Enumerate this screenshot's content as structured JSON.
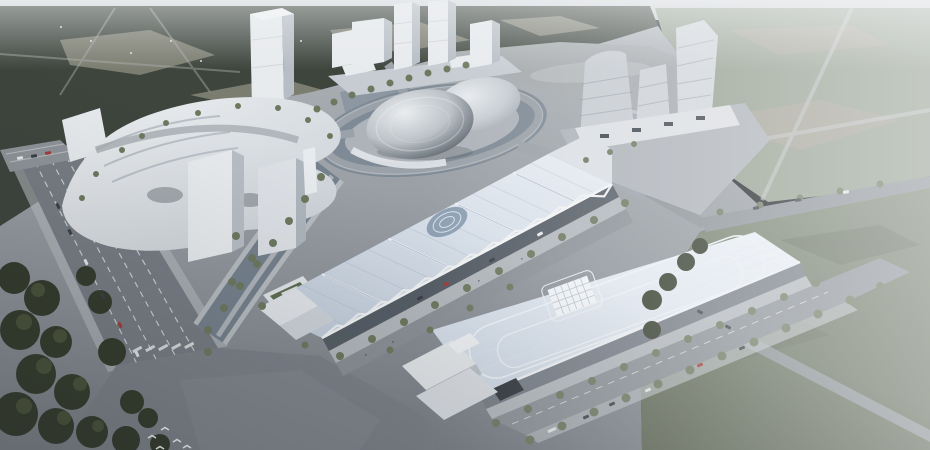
{
  "meta": {
    "type": "architectural-aerial-rendering",
    "description": "Aerial architectural rendering of a cultural and exhibition district: a metallic egg-shaped dome theater inside an elliptical ring road surrounded by water, a white terraced retail podium with slab towers on the left, twin high-rise towers and a lake at top, a cluster of twisted mid-rise towers on the right, two long exhibition halls with pale-blue metal roofs (one with a white zigzag truss facade, one with a central grid skylight), wide tree-lined boulevards with sparse traffic, dense dark forest park to the north-west and hazy sage-green woodland to the east and south-east, small white birds flying over the south-west plaza."
  },
  "colors": {
    "skyTop": "#dadde0",
    "skyBottom": "#c9cdd1",
    "forestDark": "#3d453d",
    "forestClearing": "#7b7d70",
    "forestSage": "#95a090",
    "sageClearing": "#a3a296",
    "forestSE": "#7e8876",
    "forestSEDark": "#59624f",
    "treeDark": "#343b2c",
    "treeCap": "#49523a",
    "treeStreet": "#6d785f",
    "lake": "#a6aaad",
    "waterArm": "#8d97a1",
    "canal": "#75818d",
    "ringWater": "#7e8a95",
    "ringRoad": "#9aa1a8",
    "plaza": "#aeb3b9",
    "ground": "#a9aeb3",
    "groundDark": "#7c8289",
    "roadMain": "#777d84",
    "roadMid": "#8b9197",
    "lane": "#e8eaec",
    "sidewalk": "#b7bcc1",
    "bldgWhite": "#e8ebee",
    "bldgShade": "#b6bdc4",
    "bldgDark": "#8f969e",
    "domeDark": "#474e55",
    "roofSeam": "#9fb0c2",
    "trussWhite": "#eef0f2",
    "trussDark": "#555d66",
    "hallFacade": "#757c85",
    "apron": "#b3b8bd",
    "greenRoof": "#5e6d50",
    "carDark": "#3a4046",
    "carRed": "#a33b36",
    "carWhite": "#e6e8e9",
    "bird": "#f5f6f7"
  },
  "scene": {
    "landmarks": [
      {
        "name": "dome-theater",
        "kind": "egg-shaped metallic dome with secondary shell"
      },
      {
        "name": "ring-loop",
        "kind": "elliptical elevated ring road over water moat"
      },
      {
        "name": "exhibition-hall-truss",
        "kind": "long hall, pale blue roof, white zigzag truss facade, round roof oculus"
      },
      {
        "name": "exhibition-hall-skylight",
        "kind": "long hall, pale blue roof, rounded contour lines, central grid skylight"
      },
      {
        "name": "retail-podium",
        "kind": "white terraced organic podium with two slab towers"
      },
      {
        "name": "twin-towers",
        "kind": "white twin high-rises at top center"
      },
      {
        "name": "twisted-tower-cluster",
        "kind": "three banded twisted towers on the right"
      },
      {
        "name": "lake",
        "kind": "reflective lake behind the ring"
      },
      {
        "name": "forest-park-northwest",
        "kind": "dense dark forest with clearings"
      },
      {
        "name": "woodland-east",
        "kind": "hazy sage woodland with roads"
      },
      {
        "name": "boulevards",
        "kind": "tree-lined boulevards with light traffic"
      },
      {
        "name": "birds",
        "kind": "white birds over south-west plaza"
      }
    ]
  },
  "entities": {
    "street_trees": [
      [
        208,
        330,
        4
      ],
      [
        224,
        308,
        4
      ],
      [
        240,
        286,
        4
      ],
      [
        257,
        264,
        4
      ],
      [
        273,
        243,
        4
      ],
      [
        289,
        221,
        4
      ],
      [
        305,
        199,
        4
      ],
      [
        321,
        177,
        4
      ],
      [
        352,
        95,
        3.5
      ],
      [
        371,
        89,
        3.5
      ],
      [
        390,
        83,
        3.5
      ],
      [
        409,
        78,
        3.5
      ],
      [
        428,
        73,
        3.5
      ],
      [
        447,
        69,
        3.5
      ],
      [
        466,
        65,
        3.5
      ],
      [
        334,
        102,
        3.5
      ],
      [
        317,
        109,
        3.5
      ],
      [
        340,
        356,
        4
      ],
      [
        372,
        339,
        4
      ],
      [
        404,
        322,
        4
      ],
      [
        435,
        305,
        4
      ],
      [
        467,
        288,
        4
      ],
      [
        499,
        271,
        4
      ],
      [
        531,
        254,
        4
      ],
      [
        562,
        237,
        4
      ],
      [
        594,
        220,
        4
      ],
      [
        625,
        203,
        4
      ],
      [
        390,
        350,
        3.5
      ],
      [
        430,
        330,
        3.5
      ],
      [
        470,
        308,
        3.5
      ],
      [
        510,
        287,
        3.5
      ],
      [
        496,
        423,
        4
      ],
      [
        528,
        409,
        4
      ],
      [
        560,
        395,
        4
      ],
      [
        592,
        381,
        4
      ],
      [
        624,
        367,
        4
      ],
      [
        656,
        353,
        4
      ],
      [
        688,
        339,
        4
      ],
      [
        720,
        325,
        4
      ],
      [
        752,
        311,
        4
      ],
      [
        784,
        297,
        4
      ],
      [
        816,
        283,
        4
      ],
      [
        530,
        440,
        4.5
      ],
      [
        562,
        426,
        4.5
      ],
      [
        594,
        412,
        4.5
      ],
      [
        626,
        398,
        4.5
      ],
      [
        658,
        384,
        4.5
      ],
      [
        690,
        370,
        4.5
      ],
      [
        722,
        356,
        4.5
      ],
      [
        754,
        342,
        4.5
      ],
      [
        786,
        328,
        4.5
      ],
      [
        818,
        314,
        4.5
      ],
      [
        850,
        300,
        4.5
      ],
      [
        880,
        286,
        4
      ],
      [
        720,
        212,
        3.5
      ],
      [
        760,
        205,
        3.5
      ],
      [
        800,
        198,
        3.5
      ],
      [
        840,
        191,
        3.5
      ],
      [
        880,
        184,
        3.5
      ],
      [
        122,
        150,
        3
      ],
      [
        142,
        136,
        3
      ],
      [
        166,
        123,
        3
      ],
      [
        198,
        113,
        3
      ],
      [
        238,
        106,
        3
      ],
      [
        278,
        108,
        3
      ],
      [
        308,
        120,
        3
      ],
      [
        96,
        174,
        3
      ],
      [
        82,
        198,
        3
      ],
      [
        330,
        136,
        3
      ],
      [
        236,
        236,
        4
      ],
      [
        252,
        258,
        4
      ],
      [
        232,
        282,
        4
      ],
      [
        262,
        306,
        4
      ],
      [
        208,
        352,
        4
      ],
      [
        305,
        345,
        3.5
      ],
      [
        586,
        160,
        3
      ],
      [
        610,
        152,
        3
      ],
      [
        634,
        144,
        3
      ]
    ],
    "dark_trees": [
      [
        14,
        278,
        16
      ],
      [
        42,
        298,
        18
      ],
      [
        20,
        330,
        20
      ],
      [
        56,
        342,
        16
      ],
      [
        36,
        374,
        20
      ],
      [
        72,
        392,
        18
      ],
      [
        16,
        414,
        22
      ],
      [
        56,
        426,
        18
      ],
      [
        92,
        432,
        16
      ],
      [
        100,
        302,
        12
      ],
      [
        86,
        276,
        10
      ],
      [
        112,
        352,
        14
      ],
      [
        132,
        402,
        12
      ],
      [
        126,
        440,
        14
      ],
      [
        148,
        418,
        10
      ],
      [
        160,
        444,
        10
      ],
      [
        652,
        300,
        10
      ],
      [
        668,
        282,
        9
      ],
      [
        686,
        262,
        9
      ],
      [
        700,
        246,
        8
      ],
      [
        652,
        330,
        9
      ]
    ],
    "tree_caps": [
      [
        38,
        290,
        7
      ],
      [
        24,
        322,
        8
      ],
      [
        60,
        336,
        7
      ],
      [
        44,
        366,
        8
      ],
      [
        80,
        384,
        7
      ],
      [
        24,
        406,
        8
      ],
      [
        64,
        418,
        7
      ],
      [
        98,
        426,
        6
      ]
    ],
    "cars": [
      [
        70,
        232,
        64,
        "carDark"
      ],
      [
        86,
        262,
        64,
        "carWhite"
      ],
      [
        103,
        296,
        64,
        "carDark"
      ],
      [
        120,
        325,
        64,
        "carRed"
      ],
      [
        137,
        354,
        64,
        "carWhite"
      ],
      [
        58,
        206,
        64,
        "carDark"
      ],
      [
        446,
        284,
        -28,
        "carRed"
      ],
      [
        492,
        260,
        -28,
        "carDark"
      ],
      [
        540,
        234,
        -28,
        "carWhite"
      ],
      [
        420,
        298,
        -28,
        "carDark"
      ],
      [
        552,
        430,
        -23,
        "carWhite",
        9
      ],
      [
        586,
        417,
        -23,
        "carDark"
      ],
      [
        612,
        404,
        -23,
        "carDark"
      ],
      [
        648,
        390,
        -23,
        "carWhite"
      ],
      [
        700,
        365,
        -23,
        "carRed"
      ],
      [
        742,
        348,
        -23,
        "carDark"
      ],
      [
        756,
        208,
        -10,
        "carDark"
      ],
      [
        798,
        200,
        -10,
        "carDark"
      ],
      [
        846,
        192,
        -10,
        "carWhite"
      ],
      [
        700,
        312,
        27,
        "carDark"
      ],
      [
        728,
        327,
        27,
        "carDark"
      ],
      [
        20,
        158,
        -10,
        "carWhite"
      ],
      [
        34,
        156,
        -10,
        "carDark"
      ],
      [
        48,
        153,
        -10,
        "carRed"
      ]
    ],
    "birds": [
      [
        152,
        438
      ],
      [
        165,
        430
      ],
      [
        177,
        442
      ],
      [
        187,
        448
      ],
      [
        160,
        449
      ]
    ]
  }
}
